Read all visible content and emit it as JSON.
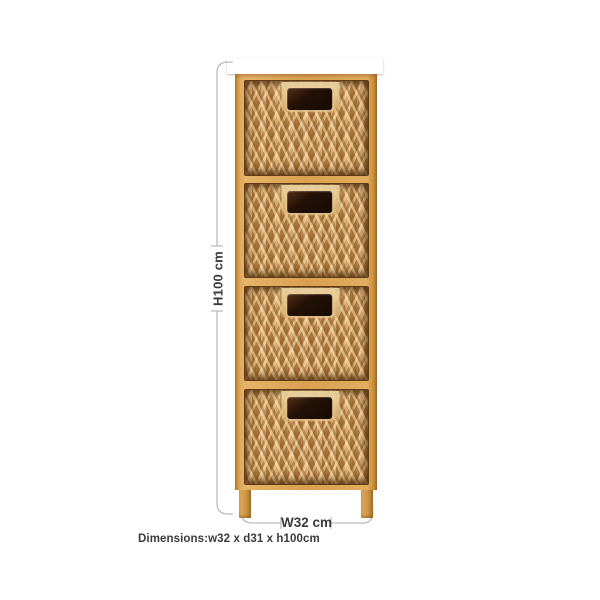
{
  "annotations": {
    "height_label": "H100 cm",
    "width_label": "W32 cm",
    "dimensions_caption": "Dimensions:w32 x d31 x h100cm"
  },
  "product": {
    "type": "storage tower with woven basket drawers",
    "drawer_count": 4
  },
  "theme": {
    "bg": "#ffffff",
    "line": "#bcbcbc",
    "text": "#3a3a3a",
    "wood": "#d9a252",
    "wood_light": "#ecc582",
    "wood_dark": "#7c4c16",
    "basket_mid": "#c9985f",
    "basket_light": "#eed7a4",
    "basket_dark": "#5e3a16",
    "handle": "#241106"
  }
}
